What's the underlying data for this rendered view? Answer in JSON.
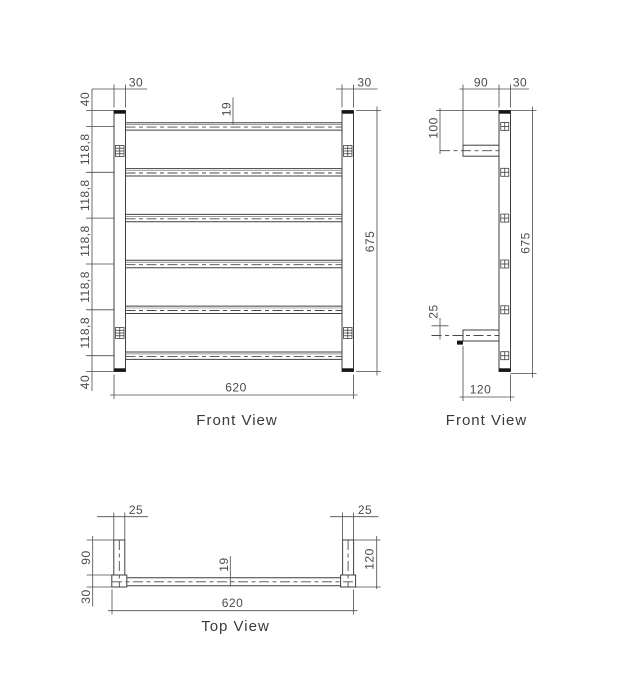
{
  "page": {
    "background_color": "#ffffff",
    "line_color": "#3f3f3f",
    "text_color": "#4a4a4a"
  },
  "front_view": {
    "label": "Front View",
    "dim_post_width_left": "30",
    "dim_post_width_right": "30",
    "dim_top_offset": "40",
    "dim_bottom_offset": "40",
    "dim_bar_spacings": [
      "118,8",
      "118,8",
      "118,8",
      "118,8",
      "118,8"
    ],
    "dim_bar_diameter": "19",
    "dim_overall_height": "675",
    "dim_overall_width": "620"
  },
  "side_view": {
    "label": "Front View",
    "dim_bracket_length": "90",
    "dim_post_depth": "30",
    "dim_top_to_bracket": "100",
    "dim_bracket_offset": "25",
    "dim_overall_height": "675",
    "dim_overall_depth": "120"
  },
  "top_view": {
    "label": "Top View",
    "dim_bracket_width_left": "25",
    "dim_bracket_width_right": "25",
    "dim_bracket_length": "90",
    "dim_post_depth": "30",
    "dim_overall_depth": "120",
    "dim_bar_diameter": "19",
    "dim_overall_width": "620"
  }
}
